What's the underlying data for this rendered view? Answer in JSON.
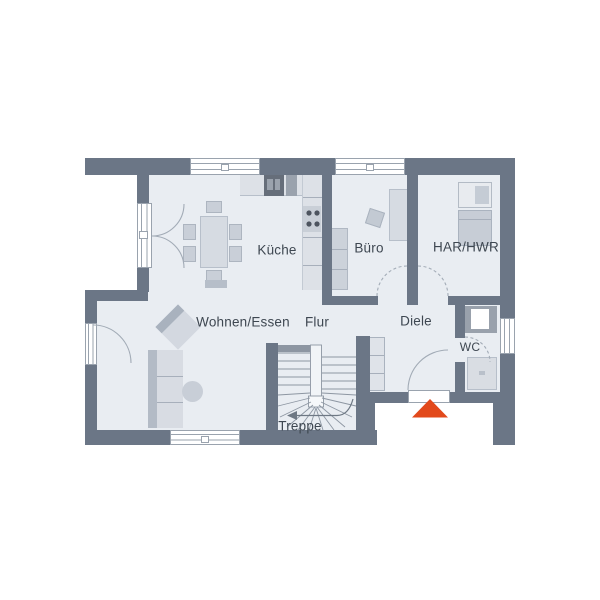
{
  "plan": {
    "type": "floorplan",
    "level": "ground-floor",
    "rooms": {
      "wohnen_essen": {
        "label": "Wohnen/Essen"
      },
      "kueche": {
        "label": "Küche"
      },
      "buero": {
        "label": "Büro"
      },
      "har_hwr": {
        "label": "HAR/HWR"
      },
      "flur": {
        "label": "Flur"
      },
      "diele": {
        "label": "Diele"
      },
      "wc": {
        "label": "WC"
      },
      "treppe": {
        "label": "Treppe"
      }
    },
    "markers": {
      "entrance": {
        "shape": "triangle-up",
        "color": "#e2491b"
      }
    },
    "colors": {
      "wall": "#6b7686",
      "floor": "#e9edf2",
      "furniture_light": "#d6dbe2",
      "furniture_mid": "#c9cfd8",
      "outline": "#9aa3ae",
      "label_text": "#3e4751",
      "entrance_marker": "#e2491b"
    }
  }
}
